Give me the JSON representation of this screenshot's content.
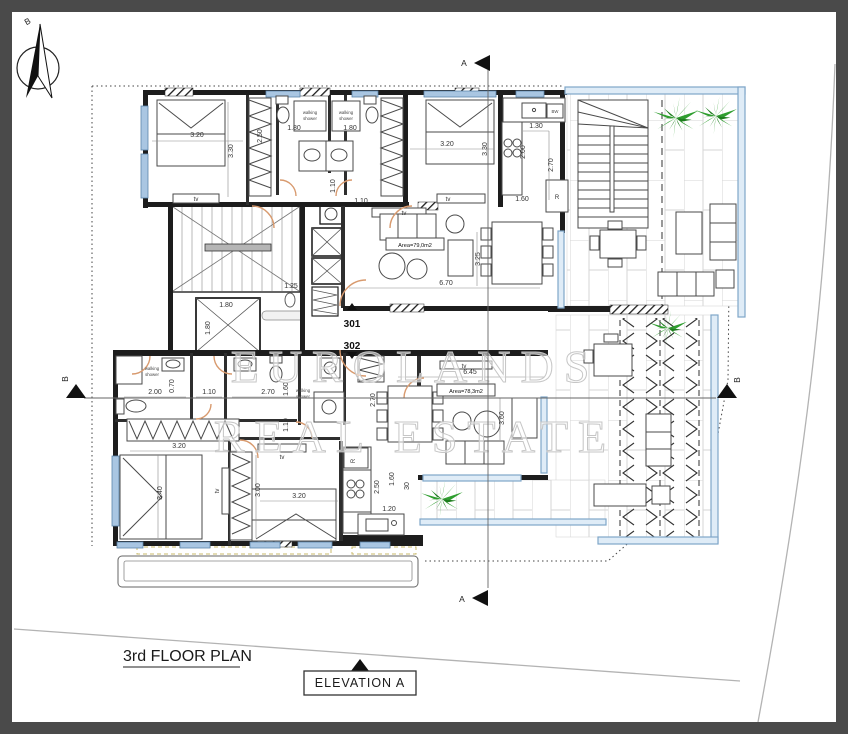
{
  "title": {
    "plan": "3rd FLOOR PLAN",
    "elevation_box": "ELEVATION A"
  },
  "north": {
    "label": "B"
  },
  "sections": {
    "a": "A",
    "b": "B"
  },
  "units": [
    {
      "number": "301",
      "area_label": "Area=79,0m2"
    },
    {
      "number": "302",
      "area_label": "Area=78,3m2"
    }
  ],
  "fixtures": {
    "tv": "tv",
    "fridge": "R",
    "dishwasher": "BW",
    "shower_line1": "walking",
    "shower_line2": "shower"
  },
  "dims": {
    "d030": "30",
    "d070": "0.70",
    "d110": "1.10",
    "d120": "1.20",
    "d125": "1.25",
    "d130": "1.30",
    "d160": "1.60",
    "d180": "1.80",
    "d200": "2.00",
    "d250": "2.50",
    "d270": "2.70",
    "d300": "3.00",
    "d320": "3.20",
    "d325": "3.25",
    "d330": "3.30",
    "d340": "3.40",
    "d360": "3.60",
    "d645": "6.45",
    "d670": "6.70"
  },
  "watermark": {
    "line1": "EUROLANDS",
    "line2": "REAL ESTATE"
  },
  "colors": {
    "wall": "#1d1d1d",
    "window": "#a9c6e2",
    "glass_rail": "#7fa6c9",
    "door": "#d89a6e",
    "plant": "#2f9e2f",
    "tile_line": "#d6d6d6",
    "dash_yellow": "#c9b96a",
    "plot_line": "#b3b3b3",
    "watermark": "#c6c6c6"
  }
}
